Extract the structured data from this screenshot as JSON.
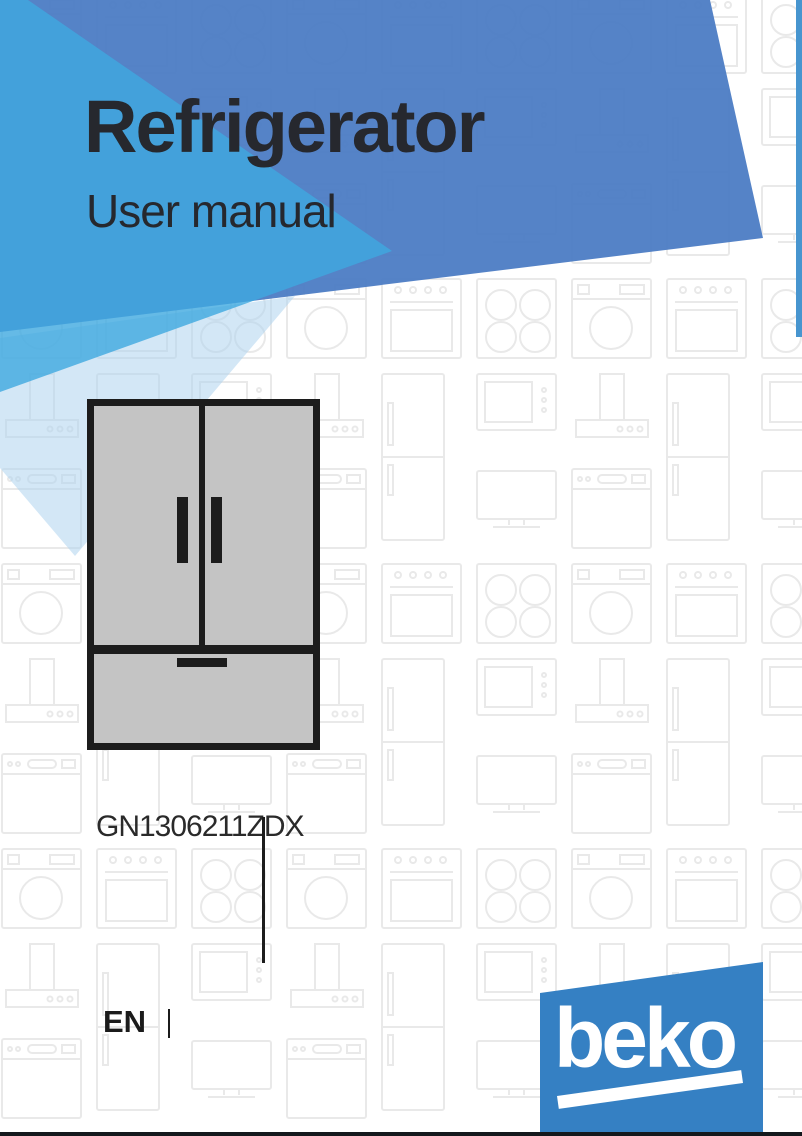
{
  "document": {
    "product_title": "Refrigerator",
    "subtitle": "User manual",
    "model_number": "GN1306211ZDX",
    "language_code": "EN",
    "brand_logo_text": "beko"
  },
  "illustration": {
    "type": "french-door-refrigerator-with-bottom-drawer"
  },
  "colors": {
    "royal_blue": "#4a7bc4",
    "cyan_blue": "#3ea9e0",
    "pale_blue": "#aed4ee",
    "accent_stripe": "#4795cf",
    "logo_blue": "#3580c3",
    "fridge_fill": "#c4c4c4",
    "ink": "#1c1c1c",
    "title_ink": "#26282e",
    "pattern_line": "#e9e9e9"
  }
}
